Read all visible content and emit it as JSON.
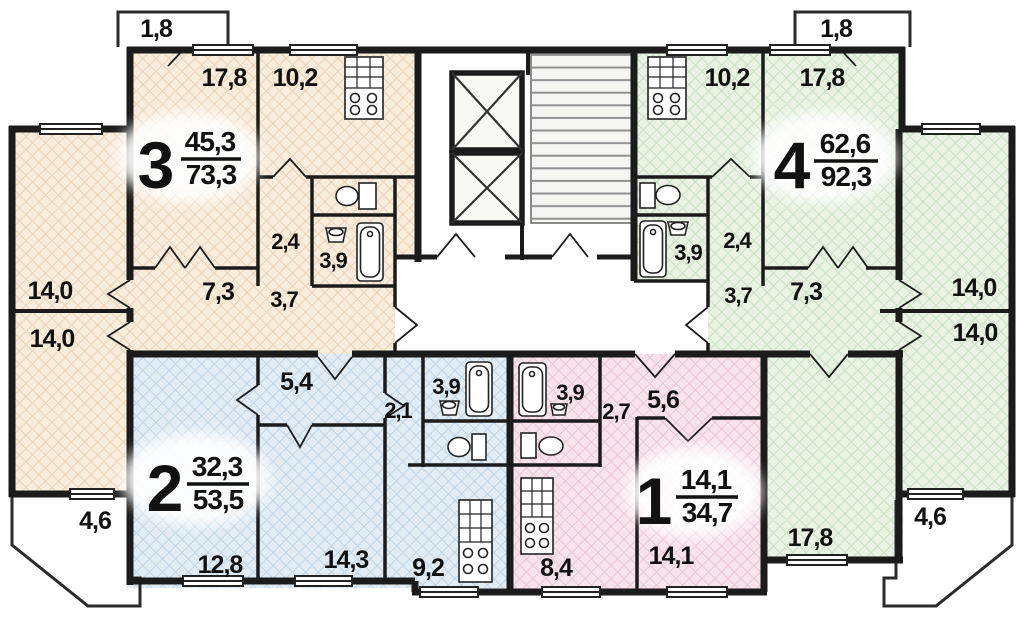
{
  "plan": {
    "apt1": {
      "number": "1",
      "area_living": "14,1",
      "area_total": "34,7",
      "rooms": {
        "room": "14,1",
        "kitchen": "8,4",
        "bath": "3,9",
        "corridor": "2,7",
        "hall": "5,6"
      }
    },
    "apt2": {
      "number": "2",
      "area_living": "32,3",
      "area_total": "53,5",
      "rooms": {
        "room_left": "12,8",
        "room_mid": "14,3",
        "kitchen": "9,2",
        "bath": "3,9",
        "corridor": "2,1",
        "hall": "5,4"
      }
    },
    "apt3": {
      "number": "3",
      "area_living": "45,3",
      "area_total": "73,3",
      "rooms": {
        "room_top": "17,8",
        "kitchen": "10,2",
        "hall": "7,3",
        "closet": "2,4",
        "bath": "3,9",
        "corridor": "3,7",
        "balcony": "1,8"
      }
    },
    "apt4": {
      "number": "4",
      "area_living": "62,6",
      "area_total": "92,3",
      "rooms": {
        "room_top": "17,8",
        "kitchen": "10,2",
        "hall": "7,3",
        "closet": "2,4",
        "bath": "3,9",
        "corridor": "3,7",
        "balcony": "1,8",
        "room_bottom": "17,8"
      }
    },
    "left_wing": {
      "room_upper": "14,0",
      "room_lower": "14,0",
      "balcony": "4,6"
    },
    "right_wing": {
      "room_upper": "14,0",
      "room_lower": "14,0",
      "balcony": "4,6"
    },
    "colors": {
      "apt1": "#f8e3ec",
      "apt2": "#e2ecf5",
      "apt3": "#f8ecdc",
      "apt4": "#e9f2e3",
      "wall": "#1b1b1b"
    }
  }
}
